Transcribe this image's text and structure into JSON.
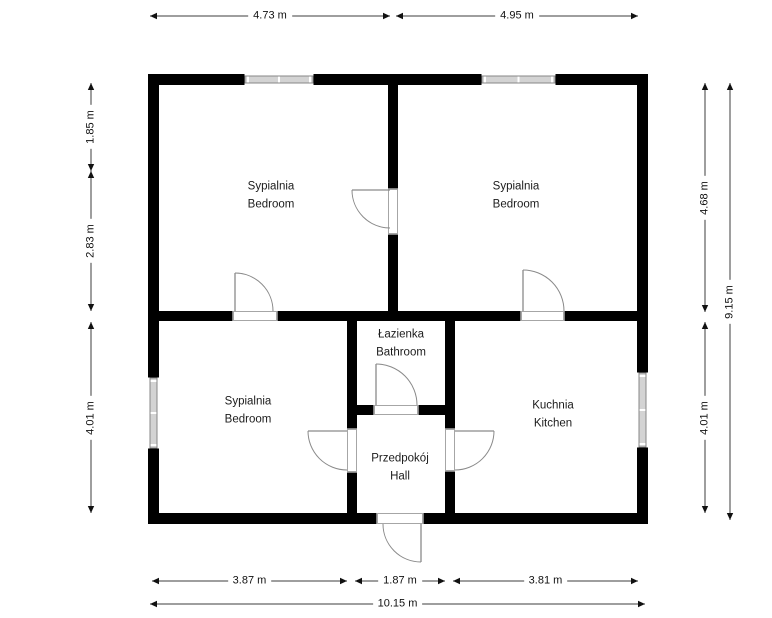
{
  "canvas": {
    "width": 772,
    "height": 618,
    "background": "#ffffff"
  },
  "colors": {
    "wall": "#000000",
    "window_fill": "#d3d3d3",
    "window_edge": "#878787",
    "opening_edge": "#a6a6a6",
    "door": "#8a8a8a",
    "dimension_line": "#3d3d3d",
    "dimension_arrow": "#111111",
    "label_text": "#1c1c1c"
  },
  "rooms": [
    {
      "id": "bedroom-top-left",
      "label_pl": "Sypialnia",
      "label_en": "Bedroom",
      "cx": 271,
      "cy": 196
    },
    {
      "id": "bedroom-top-right",
      "label_pl": "Sypialnia",
      "label_en": "Bedroom",
      "cx": 516,
      "cy": 196
    },
    {
      "id": "bedroom-bottom-left",
      "label_pl": "Sypialnia",
      "label_en": "Bedroom",
      "cx": 248,
      "cy": 411
    },
    {
      "id": "bathroom",
      "label_pl": "Łazienka",
      "label_en": "Bathroom",
      "cx": 401,
      "cy": 344
    },
    {
      "id": "hall",
      "label_pl": "Przedpokój",
      "label_en": "Hall",
      "cx": 400,
      "cy": 468
    },
    {
      "id": "kitchen",
      "label_pl": "Kuchnia",
      "label_en": "Kitchen",
      "cx": 553,
      "cy": 415
    }
  ],
  "walls": [
    {
      "name": "wall-exterior-top",
      "x": 148,
      "y": 74,
      "w": 500,
      "h": 11
    },
    {
      "name": "wall-exterior-bottom",
      "x": 148,
      "y": 513,
      "w": 500,
      "h": 11
    },
    {
      "name": "wall-exterior-left",
      "x": 148,
      "y": 74,
      "w": 11,
      "h": 450
    },
    {
      "name": "wall-exterior-right",
      "x": 637,
      "y": 74,
      "w": 11,
      "h": 450
    },
    {
      "name": "wall-bedrooms-divider",
      "x": 388,
      "y": 85,
      "w": 10,
      "h": 226
    },
    {
      "name": "wall-interior-horizontal",
      "x": 159,
      "y": 311,
      "w": 478,
      "h": 10
    },
    {
      "name": "wall-hall-left",
      "x": 347,
      "y": 321,
      "w": 10,
      "h": 192
    },
    {
      "name": "wall-hall-right",
      "x": 445,
      "y": 321,
      "w": 10,
      "h": 192
    },
    {
      "name": "wall-bathroom-bottom",
      "x": 347,
      "y": 405,
      "w": 108,
      "h": 10
    }
  ],
  "openings": [
    {
      "name": "opening-door-bedrooms-top",
      "x": 388,
      "y": 189,
      "w": 10,
      "h": 45
    },
    {
      "name": "opening-door-bedrooms-left",
      "x": 233,
      "y": 311,
      "w": 44,
      "h": 10
    },
    {
      "name": "opening-door-bedroom-right",
      "x": 521,
      "y": 311,
      "w": 43,
      "h": 10
    },
    {
      "name": "opening-door-bathroom",
      "x": 374,
      "y": 405,
      "w": 44,
      "h": 10
    },
    {
      "name": "opening-door-hall-bedroom",
      "x": 347,
      "y": 429,
      "w": 10,
      "h": 43
    },
    {
      "name": "opening-door-hall-kitchen",
      "x": 445,
      "y": 429,
      "w": 10,
      "h": 42
    },
    {
      "name": "opening-door-entrance",
      "x": 377,
      "y": 513,
      "w": 46,
      "h": 11
    }
  ],
  "windows": [
    {
      "name": "window-bedroom-top-left",
      "x": 245,
      "y": 74,
      "w": 68,
      "h": 11,
      "orient": "h"
    },
    {
      "name": "window-bedroom-top-right",
      "x": 482,
      "y": 74,
      "w": 73,
      "h": 11,
      "orient": "h"
    },
    {
      "name": "window-bedroom-bottom-left",
      "x": 148,
      "y": 378,
      "w": 11,
      "h": 70,
      "orient": "v"
    },
    {
      "name": "window-kitchen",
      "x": 637,
      "y": 373,
      "w": 11,
      "h": 74,
      "orient": "v"
    }
  ],
  "doors": [
    {
      "name": "door-bedrooms-top",
      "hinge": [
        390,
        190
      ],
      "leaf": [
        352,
        190
      ],
      "end": [
        390,
        228
      ],
      "r": 38,
      "sweep": 0
    },
    {
      "name": "door-bedrooms-left",
      "hinge": [
        235,
        311
      ],
      "leaf": [
        235,
        273
      ],
      "end": [
        273,
        311
      ],
      "r": 38,
      "sweep": 1
    },
    {
      "name": "door-bedroom-right",
      "hinge": [
        523,
        311
      ],
      "leaf": [
        523,
        270
      ],
      "end": [
        564,
        311
      ],
      "r": 41,
      "sweep": 1
    },
    {
      "name": "door-bathroom",
      "hinge": [
        376,
        405
      ],
      "leaf": [
        376,
        364
      ],
      "end": [
        417,
        405
      ],
      "r": 41,
      "sweep": 1
    },
    {
      "name": "door-hall-bedroom",
      "hinge": [
        347,
        431
      ],
      "leaf": [
        308,
        431
      ],
      "end": [
        347,
        470
      ],
      "r": 39,
      "sweep": 0
    },
    {
      "name": "door-hall-kitchen",
      "hinge": [
        455,
        431
      ],
      "leaf": [
        494,
        431
      ],
      "end": [
        455,
        470
      ],
      "r": 39,
      "sweep": 1
    },
    {
      "name": "door-entrance",
      "hinge": [
        421,
        524
      ],
      "leaf": [
        421,
        562
      ],
      "end": [
        383,
        524
      ],
      "r": 38,
      "sweep": 1
    }
  ],
  "dimensions": [
    {
      "name": "dim-top-left",
      "label": "4.73 m",
      "orient": "h",
      "x1": 150,
      "x2": 390,
      "y": 16
    },
    {
      "name": "dim-top-right",
      "label": "4.95 m",
      "orient": "h",
      "x1": 396,
      "x2": 638,
      "y": 16
    },
    {
      "name": "dim-left-upper",
      "label": "1.85 m",
      "orient": "v",
      "y1": 83,
      "y2": 171,
      "x": 91
    },
    {
      "name": "dim-left-middle",
      "label": "2.83 m",
      "orient": "v",
      "y1": 171,
      "y2": 311,
      "x": 91
    },
    {
      "name": "dim-left-lower",
      "label": "4.01 m",
      "orient": "v",
      "y1": 322,
      "y2": 513,
      "x": 91
    },
    {
      "name": "dim-right-upper",
      "label": "4.68 m",
      "orient": "v",
      "y1": 83,
      "y2": 312,
      "x": 705
    },
    {
      "name": "dim-right-lower",
      "label": "4.01 m",
      "orient": "v",
      "y1": 322,
      "y2": 513,
      "x": 705
    },
    {
      "name": "dim-right-total",
      "label": "9.15 m",
      "orient": "v",
      "y1": 83,
      "y2": 520,
      "x": 730
    },
    {
      "name": "dim-bottom-left",
      "label": "3.87 m",
      "orient": "h",
      "x1": 152,
      "x2": 347,
      "y": 581
    },
    {
      "name": "dim-bottom-middle",
      "label": "1.87 m",
      "orient": "h",
      "x1": 355,
      "x2": 445,
      "y": 581
    },
    {
      "name": "dim-bottom-right",
      "label": "3.81 m",
      "orient": "h",
      "x1": 453,
      "x2": 638,
      "y": 581
    },
    {
      "name": "dim-bottom-total",
      "label": "10.15 m",
      "orient": "h",
      "x1": 150,
      "x2": 645,
      "y": 604
    }
  ]
}
